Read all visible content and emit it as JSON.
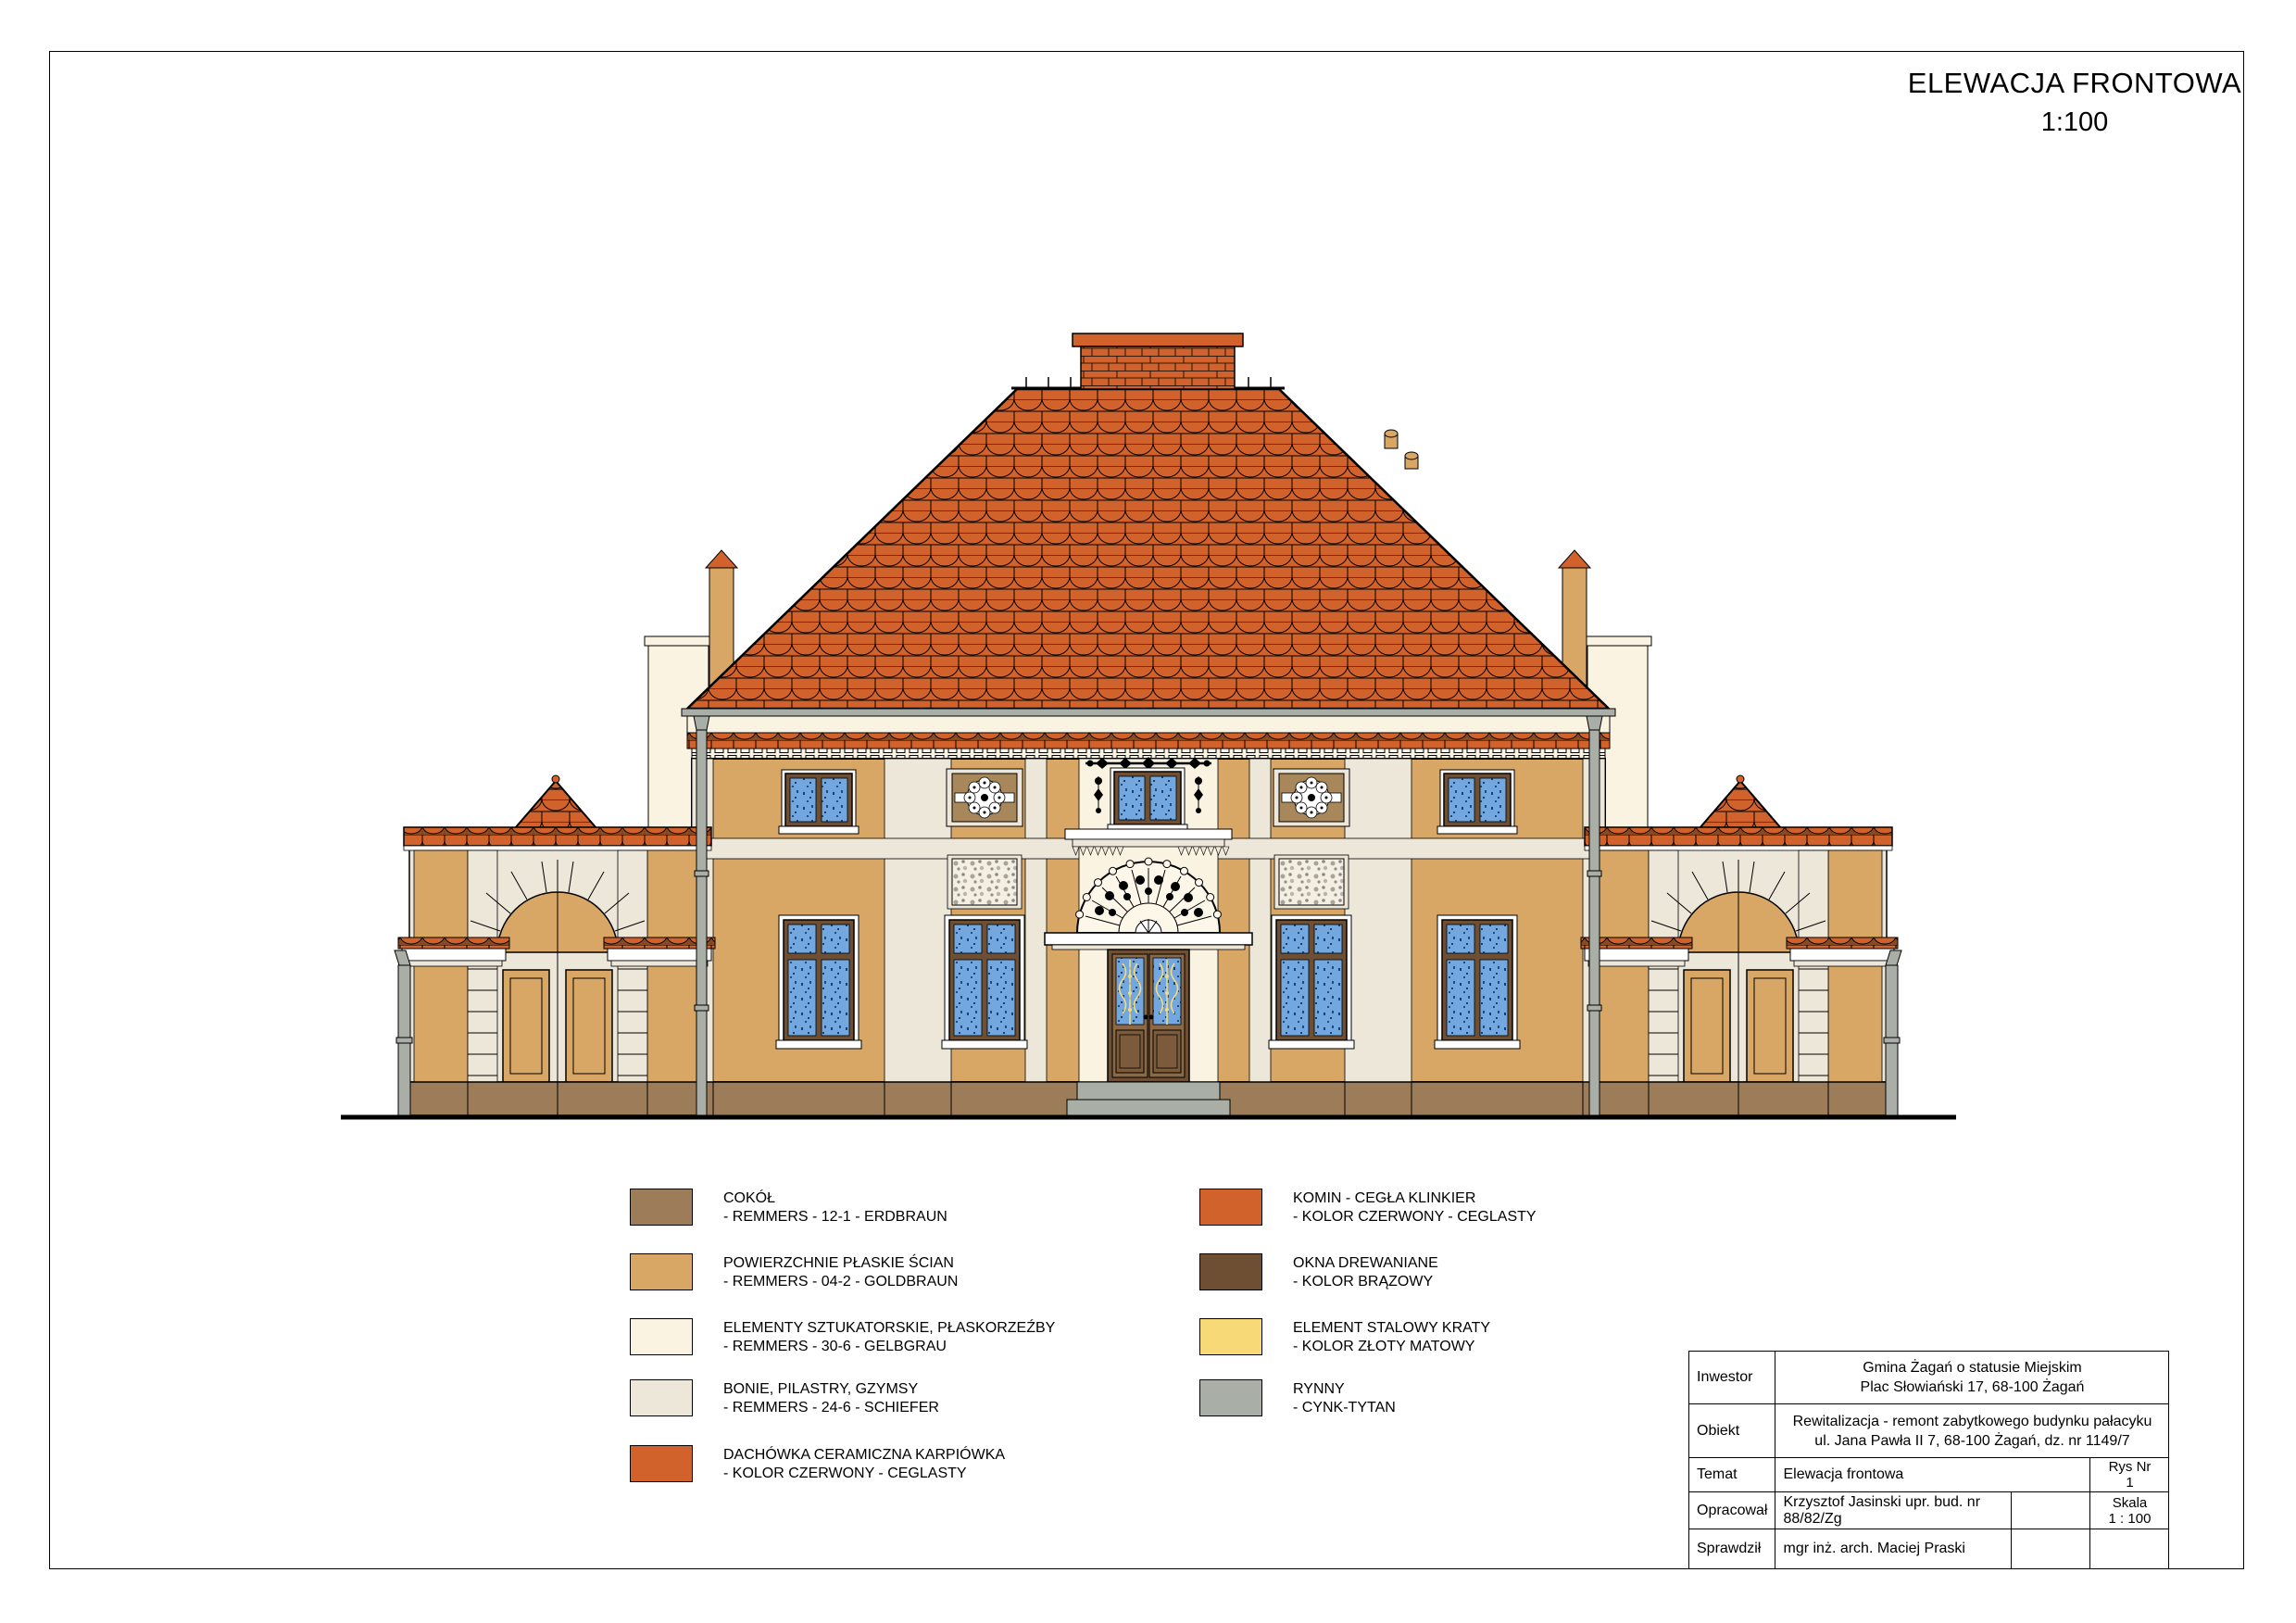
{
  "page": {
    "title": "ELEWACJA FRONTOWA",
    "scale": "1:100"
  },
  "palette": {
    "cokol": "#9C7C59",
    "goldbraun": "#D8A766",
    "gelbgrau": "#FBF3E1",
    "schiefer": "#EDE7DA",
    "dachowka": "#D2622B",
    "komin": "#D2622B",
    "okna": "#6E4F33",
    "krata": "#F8D977",
    "rynny": "#A9AEA7",
    "glass": "#72A7E0",
    "door": "#8C6845",
    "roof_gap": "#CE8052",
    "rosette_bg": "#A8875A"
  },
  "legend": {
    "left": [
      {
        "label": "COKÓŁ",
        "spec": "- REMMERS - 12-1 - ERDBRAUN",
        "palette": "cokol"
      },
      {
        "label": "POWIERZCHNIE PŁASKIE ŚCIAN",
        "spec": "- REMMERS - 04-2 - GOLDBRAUN",
        "palette": "goldbraun"
      },
      {
        "label": "ELEMENTY SZTUKATORSKIE, PŁASKORZEŹBY",
        "spec": "- REMMERS - 30-6 - GELBGRAU",
        "palette": "gelbgrau"
      },
      {
        "label": "BONIE, PILASTRY, GZYMSY",
        "spec": "- REMMERS - 24-6 - SCHIEFER",
        "palette": "schiefer"
      },
      {
        "label": "DACHÓWKA CERAMICZNA KARPIÓWKA",
        "spec": "- KOLOR CZERWONY - CEGLASTY",
        "palette": "dachowka"
      }
    ],
    "right": [
      {
        "label": "KOMIN - CEGŁA KLINKIER",
        "spec": "- KOLOR CZERWONY - CEGLASTY",
        "palette": "komin"
      },
      {
        "label": "OKNA DREWANIANE",
        "spec": "- KOLOR BRĄZOWY",
        "palette": "okna"
      },
      {
        "label": "ELEMENT STALOWY KRATY",
        "spec": "- KOLOR ZŁOTY MATOWY",
        "palette": "krata"
      },
      {
        "label": "RYNNY",
        "spec": "- CYNK-TYTAN",
        "palette": "rynny"
      }
    ]
  },
  "titleblock": {
    "inwestor_label": "Inwestor",
    "inwestor_line1": "Gmina Żagań o statusie Miejskim",
    "inwestor_line2": "Plac Słowiański 17, 68-100 Żagań",
    "obiekt_label": "Obiekt",
    "obiekt_line1": "Rewitalizacja - remont zabytkowego budynku pałacyku",
    "obiekt_line2": "ul. Jana Pawła II 7, 68-100 Żagań, dz. nr 1149/7",
    "temat_label": "Temat",
    "temat_value": "Elewacja frontowa",
    "rysnr_label": "Rys Nr",
    "rysnr_value": "1",
    "opracowal_label": "Opracował",
    "opracowal_value": "Krzysztof Jasinski upr. bud. nr 88/82/Zg",
    "skala_label": "Skala",
    "skala_value": "1 : 100",
    "sprawdzil_label": "Sprawdził",
    "sprawdzil_value": "mgr inż. arch. Maciej Praski"
  }
}
